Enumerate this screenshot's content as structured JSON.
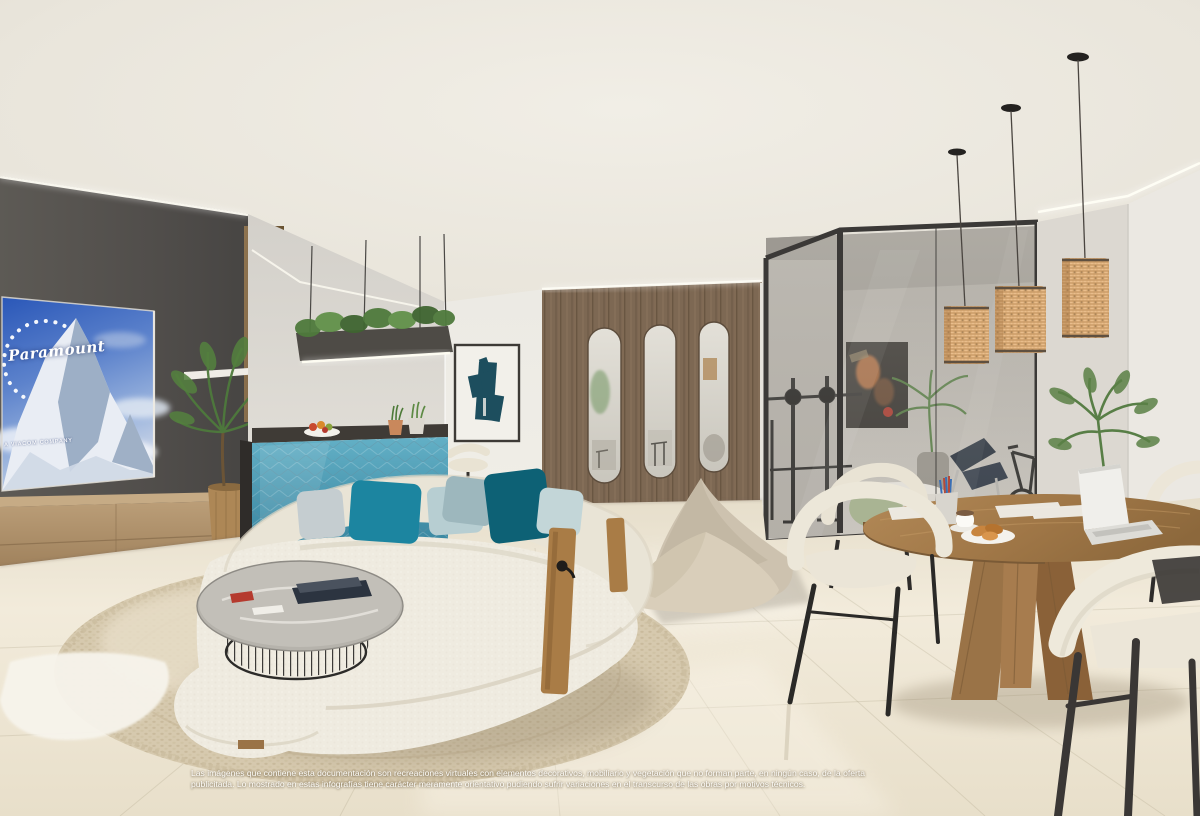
{
  "scene": {
    "description": "Photorealistic interior render: open-plan living room with TV lounge, kitchen bar, wooden slatted partition, glass-walled gym and dining area"
  },
  "tv_screen": {
    "brand": "Paramount",
    "subtitle": "A VIACOM COMPANY"
  },
  "disclaimer": {
    "line1": "Las imágenes que contiene esta documentación son recreaciones virtuales con elementos decorativos, mobiliario y vegetación que no forman parte, en ningún caso, de la oferta",
    "line2": "publicitada. Lo mostrado en estas infografías tiene carácter meramente orientativo pudiendo sufrir variaciones en el transcurso de las obras por motivos técnicos."
  },
  "palette": {
    "ceiling": "#e9e5dc",
    "dark_wall": "#565350",
    "partition_wood": "#7d6853",
    "floor": "#eee7d9",
    "rug": "#d5c8ad",
    "sofa": "#ece8dd",
    "pillow_teal": "#1c85a0",
    "pillow_dark_teal": "#0d6175",
    "bar_front_teal": "#4f9cb5",
    "rattan_pendant": "#e9bd8b",
    "dining_wood": "#a27a4e",
    "chair_cream": "#ece6d8",
    "glass_frame": "#3b3937",
    "tv_sky": "#3a6bc8"
  }
}
